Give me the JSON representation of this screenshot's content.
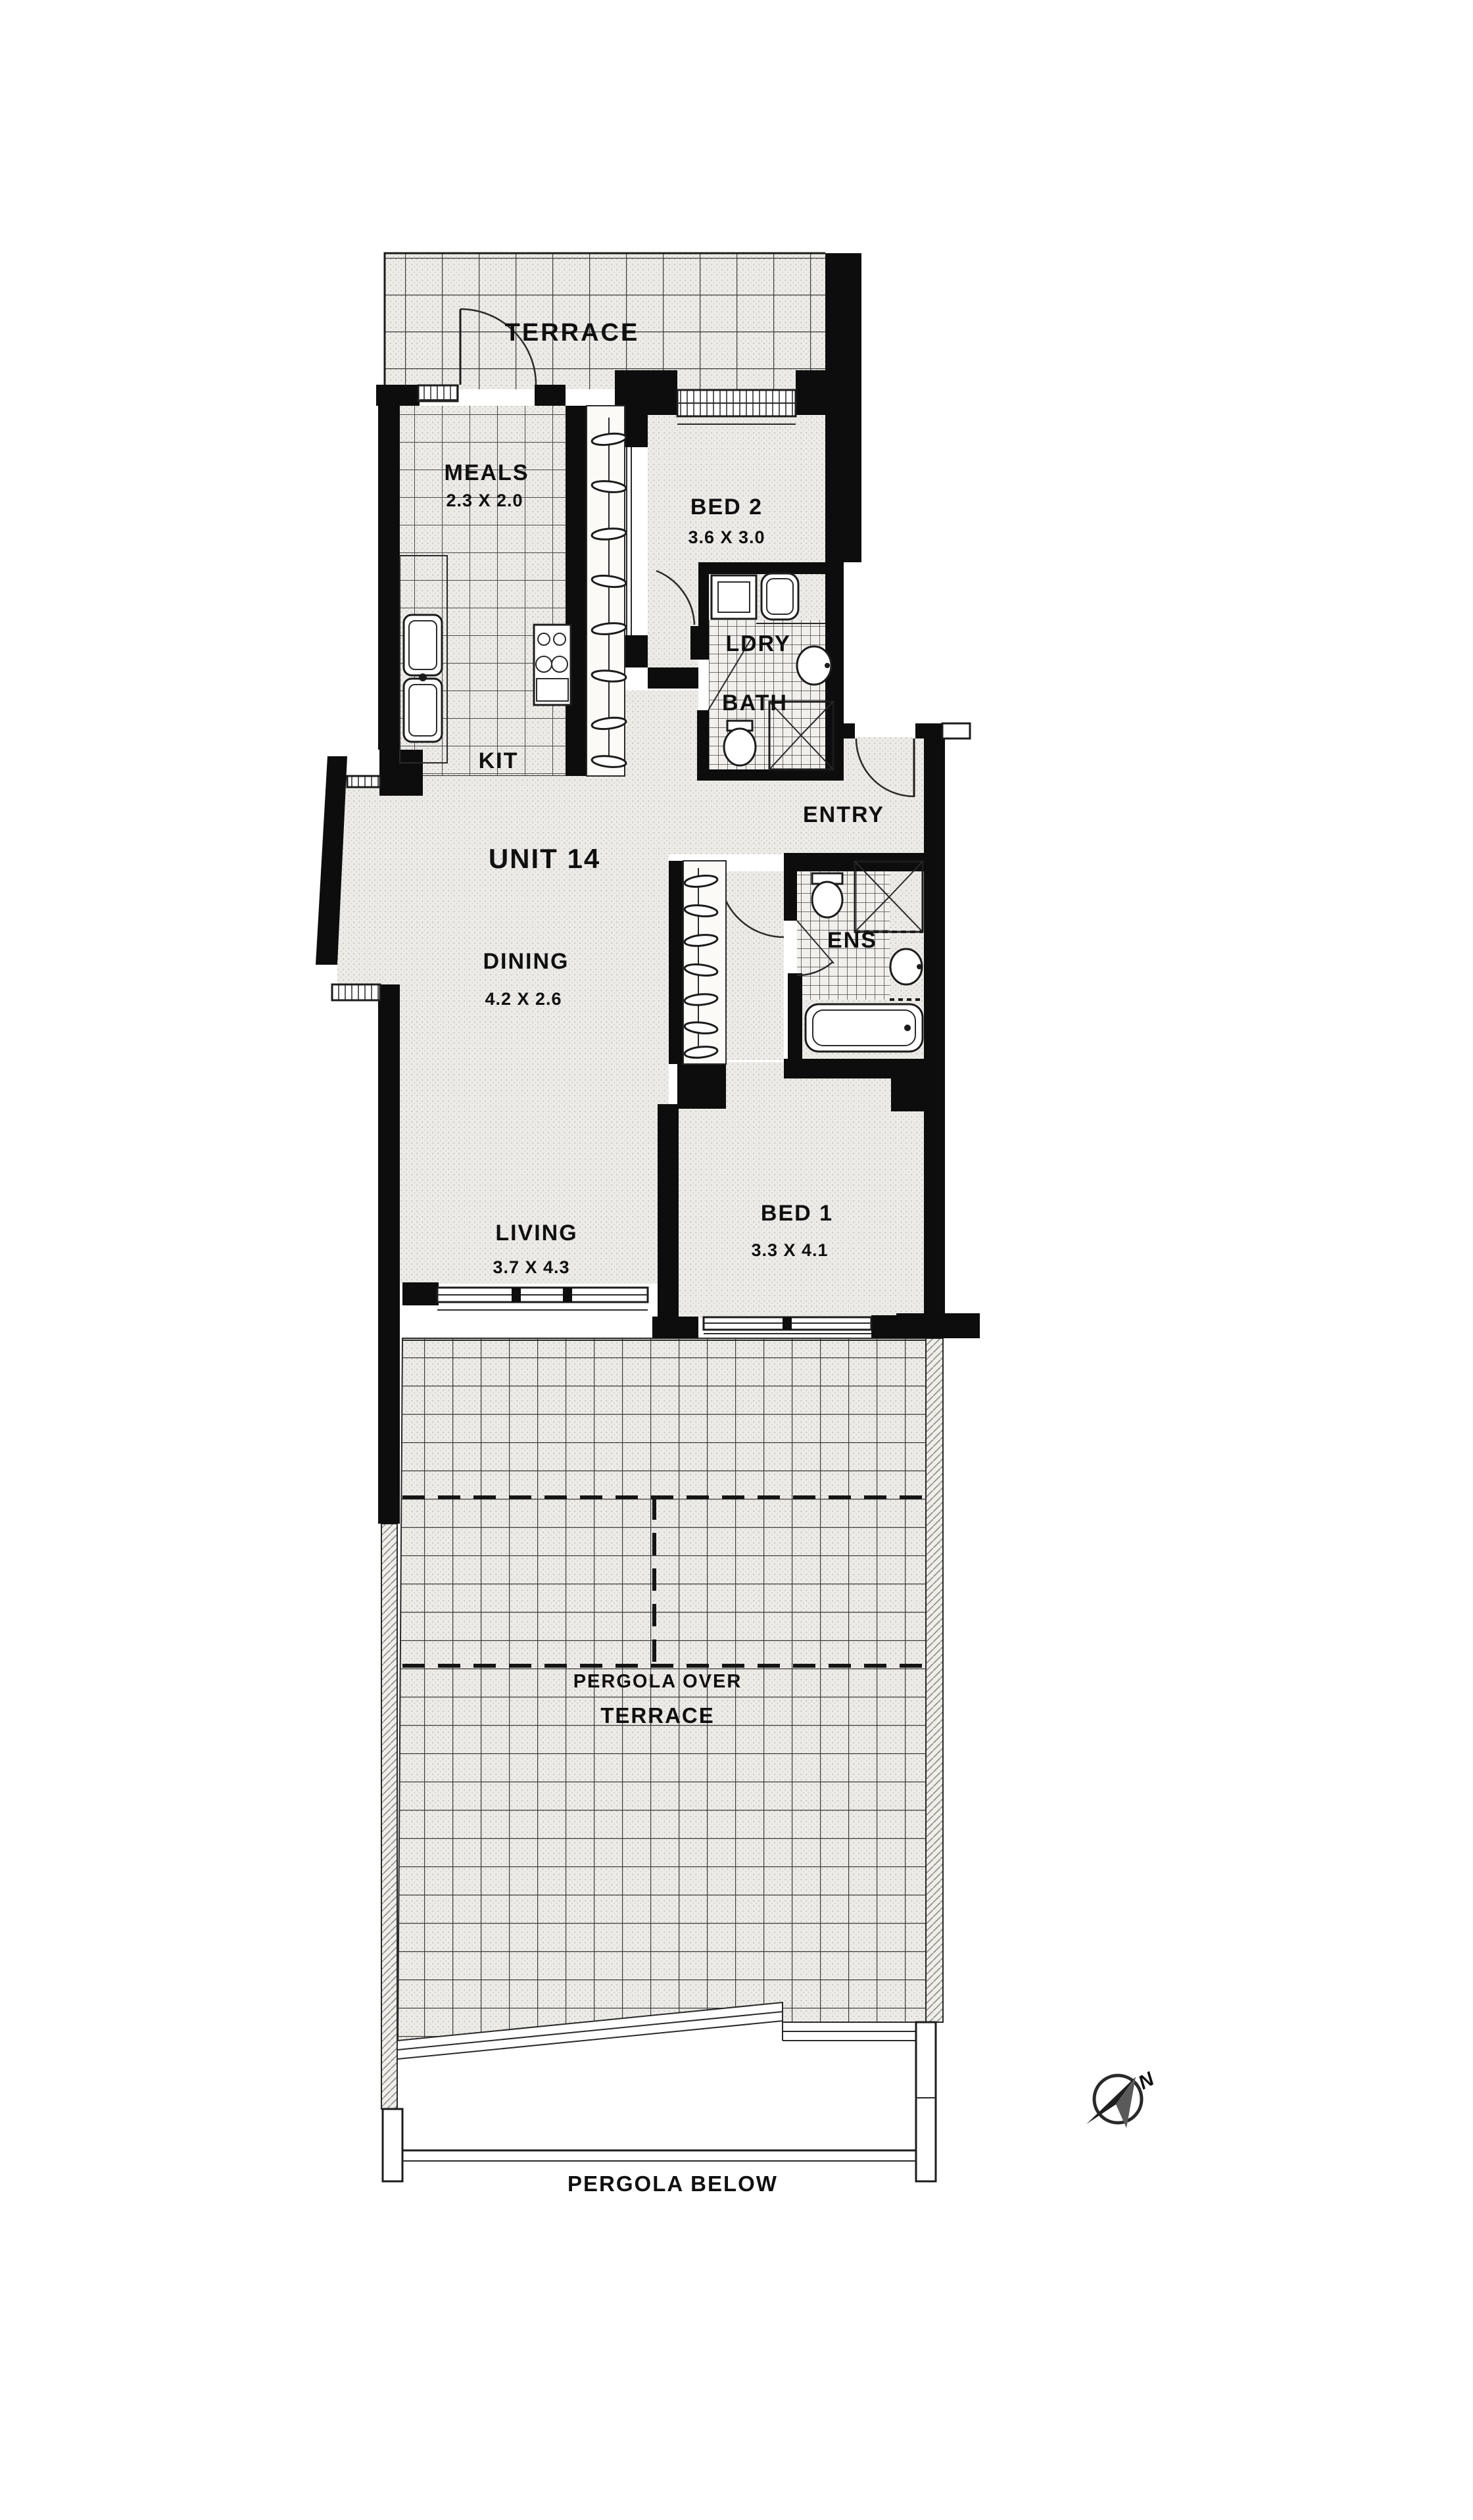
{
  "plan": {
    "annotations": {
      "unit": "UNIT 14",
      "pergola_over_line1": "PERGOLA OVER",
      "pergola_over_line2": "TERRACE",
      "pergola_below": "PERGOLA BELOW",
      "compass_north": "N"
    },
    "rooms": [
      {
        "id": "terrace-top",
        "label": "TERRACE",
        "dimensions": ""
      },
      {
        "id": "meals",
        "label": "MEALS",
        "dimensions": "2.3 X 2.0"
      },
      {
        "id": "bed2",
        "label": "BED 2",
        "dimensions": "3.6 X 3.0"
      },
      {
        "id": "kitchen",
        "label": "KIT",
        "dimensions": ""
      },
      {
        "id": "laundry",
        "label": "LDRY",
        "dimensions": ""
      },
      {
        "id": "bathroom",
        "label": "BATH",
        "dimensions": ""
      },
      {
        "id": "entry",
        "label": "ENTRY",
        "dimensions": ""
      },
      {
        "id": "dining",
        "label": "DINING",
        "dimensions": "4.2 X 2.6"
      },
      {
        "id": "ensuite",
        "label": "ENS",
        "dimensions": ""
      },
      {
        "id": "living",
        "label": "LIVING",
        "dimensions": "3.7 X 4.3"
      },
      {
        "id": "bed1",
        "label": "BED 1",
        "dimensions": "3.3 X 4.1"
      }
    ],
    "colors": {
      "wall": "#0d0d0d",
      "paper": "#ffffff",
      "floor": "#ecebe7",
      "tile_line": "#3c3c3c"
    }
  }
}
